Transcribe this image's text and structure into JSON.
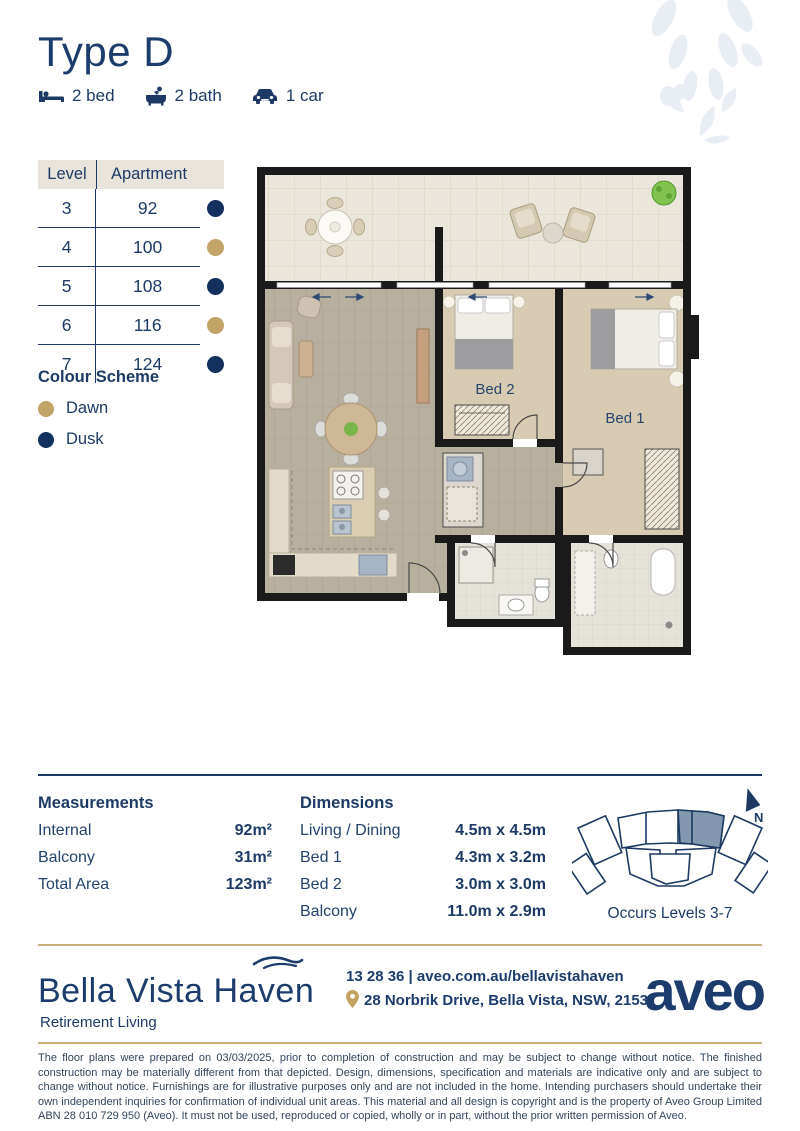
{
  "colors": {
    "navy": "#1d3a66",
    "gold": "#c2a368",
    "gold_rule": "#c9ae79",
    "dawn": "#c2a368",
    "dusk": "#12315f",
    "keyplan_highlight": "#8298ae"
  },
  "header": {
    "title": "Type D",
    "features": [
      {
        "icon": "bed-icon",
        "label": "2 bed"
      },
      {
        "icon": "bath-icon",
        "label": "2 bath"
      },
      {
        "icon": "car-icon",
        "label": "1 car"
      }
    ]
  },
  "availability": {
    "col_level": "Level",
    "col_apartment": "Apartment",
    "rows": [
      {
        "level": "3",
        "apartment": "92",
        "scheme": "Dusk",
        "color": "#12315f"
      },
      {
        "level": "4",
        "apartment": "100",
        "scheme": "Dawn",
        "color": "#c2a368"
      },
      {
        "level": "5",
        "apartment": "108",
        "scheme": "Dusk",
        "color": "#12315f"
      },
      {
        "level": "6",
        "apartment": "116",
        "scheme": "Dawn",
        "color": "#c2a368"
      },
      {
        "level": "7",
        "apartment": "124",
        "scheme": "Dusk",
        "color": "#12315f"
      }
    ]
  },
  "colour_scheme": {
    "title": "Colour Scheme",
    "items": [
      {
        "label": "Dawn",
        "color": "#c2a368"
      },
      {
        "label": "Dusk",
        "color": "#12315f"
      }
    ]
  },
  "floor_plan": {
    "bed1_label": "Bed 1",
    "bed2_label": "Bed 2"
  },
  "measurements": {
    "title": "Measurements",
    "rows": [
      {
        "label": "Internal",
        "value": "92m²"
      },
      {
        "label": "Balcony",
        "value": "31m²"
      },
      {
        "label": "Total Area",
        "value": "123m²"
      }
    ]
  },
  "dimensions": {
    "title": "Dimensions",
    "rows": [
      {
        "label": "Living / Dining",
        "value": "4.5m x 4.5m"
      },
      {
        "label": "Bed 1",
        "value": "4.3m x 3.2m"
      },
      {
        "label": "Bed 2",
        "value": "3.0m x 3.0m"
      },
      {
        "label": "Balcony",
        "value": "11.0m x 2.9m"
      }
    ]
  },
  "key_plan": {
    "north_label": "N",
    "caption": "Occurs Levels 3-7"
  },
  "footer": {
    "brand": "Bella Vista Haven",
    "tagline": "Retirement Living",
    "contact": "13 28 36 | aveo.com.au/bellavistahaven",
    "address": "28 Norbrik Drive, Bella Vista, NSW, 2153",
    "logo_text": "aveo"
  },
  "disclaimer": "The floor plans were prepared on 03/03/2025, prior to completion of construction and may be subject to change without notice. The finished construction may be materially different from that depicted. Design, dimensions, specification and materials are indicative only and are subject to change without notice. Furnishings are for illustrative purposes only and are not included in the home. Intending purchasers should undertake their own independent inquiries for confirmation of individual unit areas. This material and all design is copyright and is the property of Aveo Group Limited ABN 28 010 729 950 (Aveo). It must not be used, reproduced or copied, wholly or in part, without the prior written permission of Aveo."
}
